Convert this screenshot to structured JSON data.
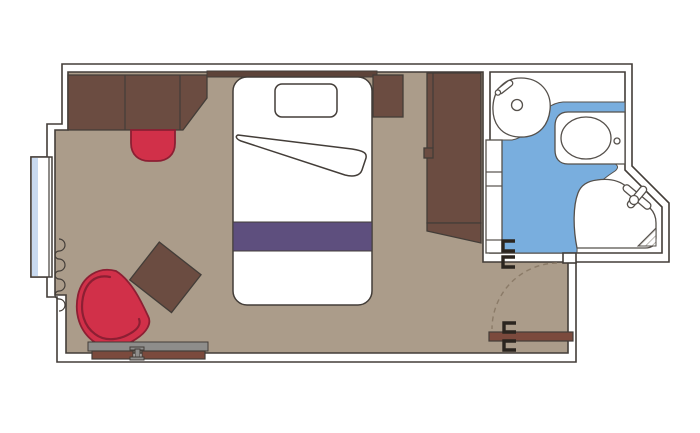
{
  "colors": {
    "page_bg": "#ffffff",
    "wall_fill": "#ffffff",
    "outline": "#433d38",
    "floor": "#ab9c8a",
    "wood": "#6b4c41",
    "wood_dark": "#5d4339",
    "accent_red": "#d13049",
    "accent_red_dark": "#8c1f33",
    "bed_runner_purple": "#5e4f7e",
    "bathroom_blue": "#79aede",
    "window_glass": "#c9daf0",
    "door_brown": "#7b4a3d",
    "desk_gray": "#8e8d8b",
    "hinge_dark": "#2b251f",
    "fixture_fill": "#ffffff",
    "fixture_stroke": "#55504b",
    "swing_dash": "#8b7b68",
    "hatch_line": "#9a968f"
  },
  "floorplan": {
    "type": "cruise-ship-cabin-floor-plan",
    "rooms": [
      {
        "name": "cabin",
        "floor_color_key": "floor"
      },
      {
        "name": "bathroom",
        "floor_color_key": "bathroom_blue"
      },
      {
        "name": "entry-hall",
        "floor_color_key": "floor"
      }
    ],
    "features": [
      "window",
      "curtain",
      "sofa",
      "ottoman",
      "headboard-shelf",
      "single-bed",
      "pillow",
      "bed-sheet-fold",
      "bed-runner",
      "nightstand",
      "wardrobe",
      "side-table",
      "armchair",
      "vanity-desk",
      "entrance-door",
      "door-swing-arc",
      "door-hinges",
      "shelf-unit",
      "washbasin",
      "faucet",
      "toilet",
      "flush-button",
      "shower-tray",
      "shower-head",
      "shower-drain-hatch"
    ]
  }
}
